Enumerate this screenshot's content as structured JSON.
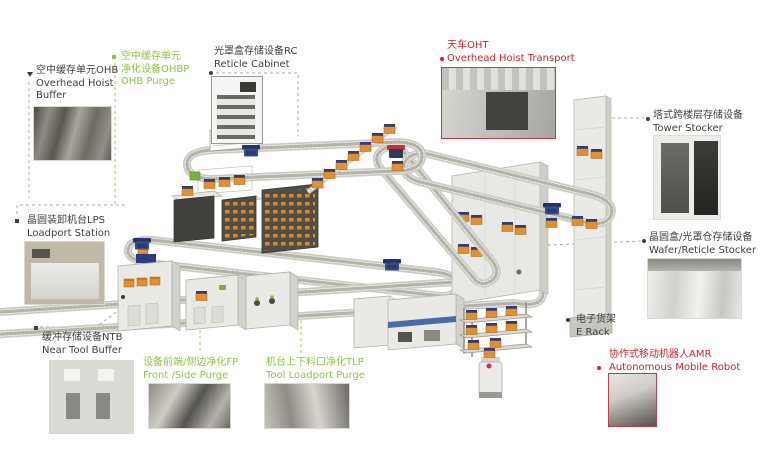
{
  "labels": {
    "ohb": {
      "zh": "空中缓存单元OHB",
      "en": "Overhead Hoist Buffer"
    },
    "ohbp": {
      "zh1": "空中缓存单元",
      "zh2": "净化设备OHBP",
      "en": "OHB Purge"
    },
    "rc": {
      "zh": "光罩盒存储设备RC",
      "en": "Reticle Cabinet"
    },
    "oht": {
      "zh": "天车OHT",
      "en": "Overhead Hoist Transport"
    },
    "tower": {
      "zh": "塔式跨楼层存储设备",
      "en": "Tower Stocker"
    },
    "wrs": {
      "zh": "晶圆盒/光罩仓存储设备",
      "en": "Wafer/Reticle Stocker"
    },
    "erack": {
      "zh": "电子货架",
      "en": "E Rack"
    },
    "amr": {
      "zh": "协作式移动机器人AMR",
      "en": "Autonomous Mobile Robot"
    },
    "lps": {
      "zh": "晶圆装卸机台LPS",
      "en": "Loadport Station"
    },
    "ntb": {
      "zh": "缓冲存储设备NTB",
      "en": "Near Tool Buffer"
    },
    "fp": {
      "zh": "设备前端/侧边净化FP",
      "en": "Front /Side Purge"
    },
    "tlp": {
      "zh": "机台上下料口净化TLP",
      "en": "Tool Loadport Purge"
    }
  },
  "colors": {
    "black_label": "#3f3f3f",
    "green_label": "#8cc63f",
    "red_label": "#c9252c",
    "foup_orange": "#e2902f",
    "vehicle_navy": "#2c3c7c",
    "track_gray": "#cbcbc3",
    "photo_red_border": "#c9374a"
  },
  "icons": {
    "foup-carrier-icon": "orange box with navy lid",
    "oht-vehicle-icon": "navy shuttle on rail",
    "track": "dotted gray overhead rail",
    "bullet-markers": "dot / square / triangle with dashed leader lines"
  }
}
